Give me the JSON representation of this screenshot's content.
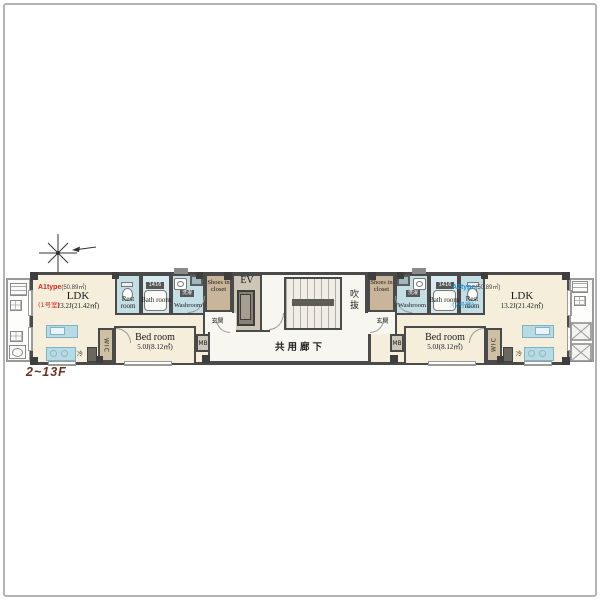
{
  "floor_label": "2~13F",
  "core": {
    "elevator": "EV",
    "atrium": "吹抜",
    "corridor": "共用廊下"
  },
  "rooms": {
    "ldk": "LDK",
    "ldk_size": "13.2J(21.42㎡)",
    "bedroom": "Bed room",
    "bedroom_size": "5.0J(8.12㎡)",
    "restroom": "Rest room",
    "bathroom": "Bath room",
    "washroom": "Washroom",
    "shoes_closet": "Shoes in closet",
    "entrance": "玄関",
    "wic": "WIC",
    "meter_box": "MB",
    "fridge": "冷",
    "laundry": "洗濯",
    "bath_module": "1416"
  },
  "units": {
    "a1": {
      "type": "A1type",
      "area": "(50.89㎡)",
      "room_no": "(1号室)",
      "accent": "#d6281e"
    },
    "a2": {
      "type": "A2type",
      "area": "(50.89㎡)",
      "room_no": "(2号室)",
      "accent": "#1f8ed6"
    }
  },
  "colors": {
    "wall": "#4a4a4a",
    "floor_cream": "#f4eedb",
    "wet_blue": "#c3dfe5",
    "closet_tan": "#c8b59a",
    "floor_label_color": "#6b3322"
  }
}
